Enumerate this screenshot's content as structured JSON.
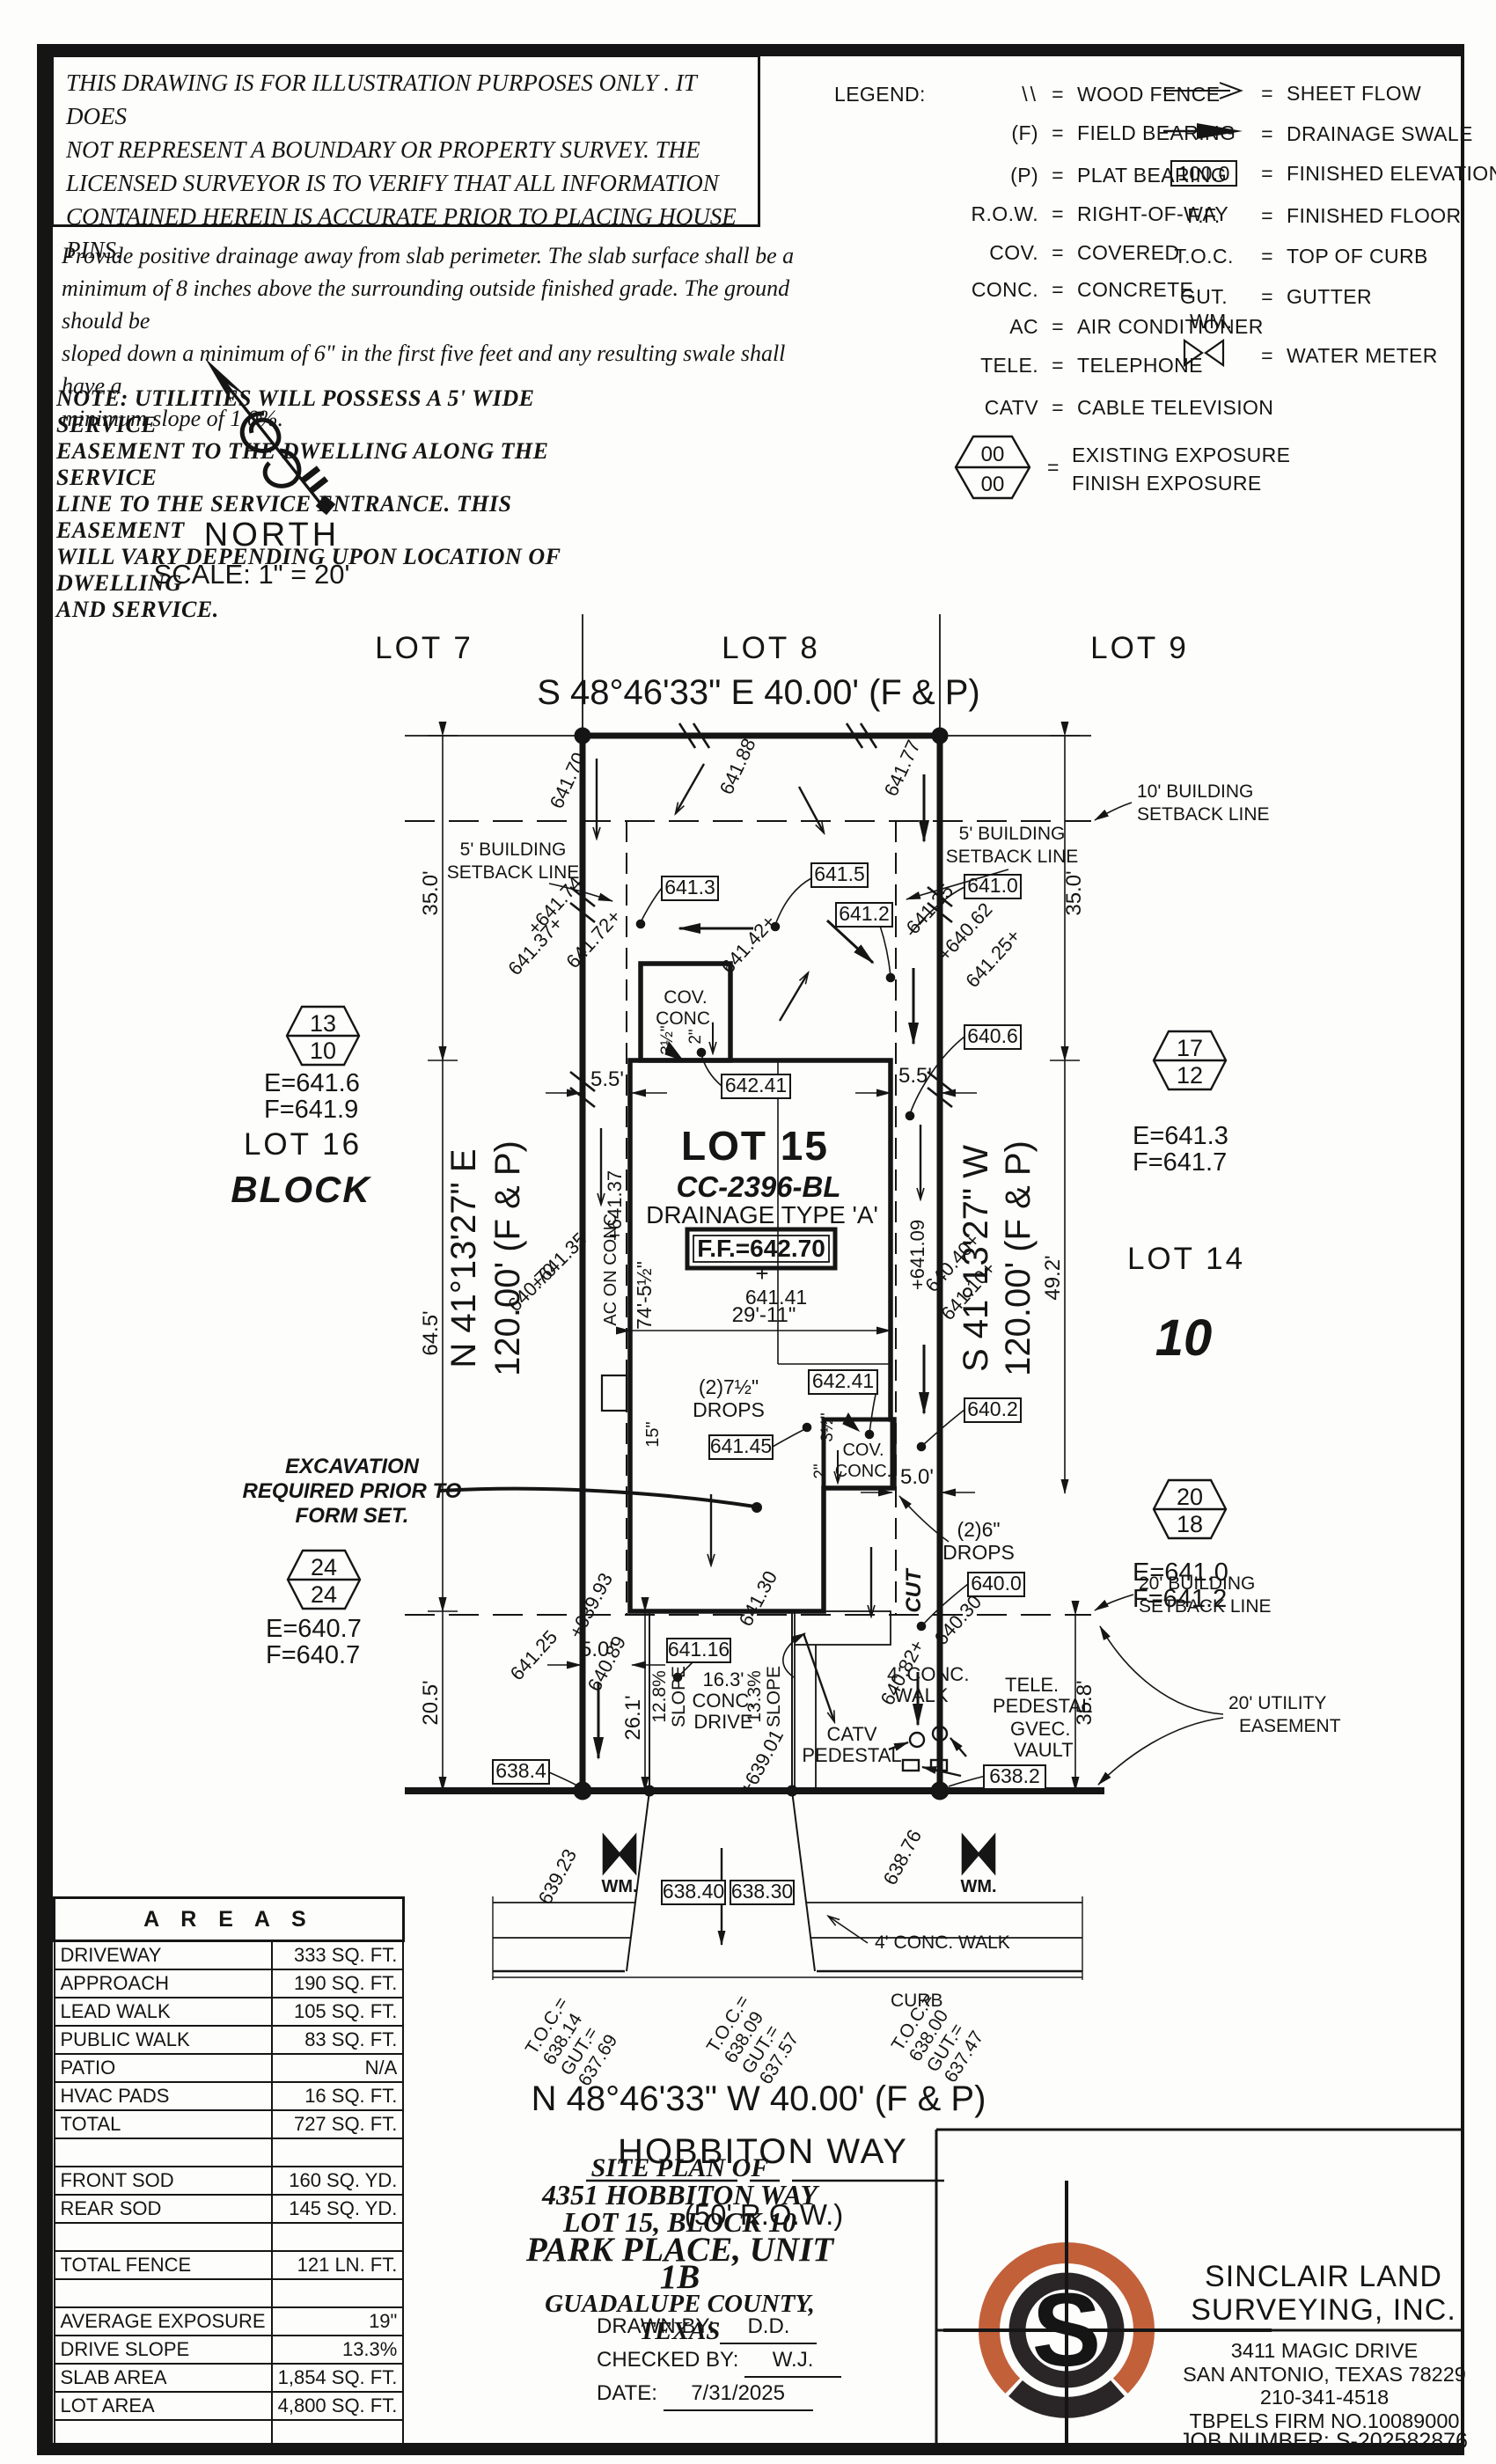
{
  "disclaimer": {
    "l1": "THIS DRAWING IS FOR ILLUSTRATION PURPOSES ONLY . IT DOES",
    "l2": "NOT REPRESENT A BOUNDARY OR PROPERTY SURVEY. THE",
    "l3": "LICENSED SURVEYOR IS TO VERIFY THAT ALL INFORMATION",
    "l4": "CONTAINED HEREIN IS ACCURATE PRIOR TO PLACING HOUSE PINS."
  },
  "drainage_note": {
    "l1": "Provide positive drainage away from slab perimeter. The slab surface shall be a",
    "l2": "minimum of 8 inches above the surrounding outside finished grade. The ground should be",
    "l3": "sloped down a minimum of 6\" in the first five feet and any resulting swale shall have a",
    "l4": "minimum slope of 1.0%."
  },
  "utility_note": {
    "l1": "NOTE:  UTILITIES  WILL  POSSESS  A  5'  WIDE  SERVICE",
    "l2": "EASEMENT  TO  THE  DWELLING  ALONG  THE  SERVICE",
    "l3": "LINE  TO  THE  SERVICE  ENTRANCE.  THIS  EASEMENT",
    "l4": "WILL  VARY  DEPENDING  UPON  LOCATION  OF  DWELLING",
    "l5": "AND  SERVICE."
  },
  "north": {
    "label": "NORTH",
    "scale": "SCALE:  1\" =  20'"
  },
  "legend": {
    "title": "LEGEND:",
    "eq": "=",
    "c1": [
      {
        "sym": "\\\\",
        "desc": "WOOD FENCE"
      },
      {
        "sym": "(F)",
        "desc": "FIELD BEARING"
      },
      {
        "sym": "(P)",
        "desc": "PLAT BEARING"
      },
      {
        "sym": "R.O.W.",
        "desc": "RIGHT-OF-WAY"
      },
      {
        "sym": "COV.",
        "desc": "COVERED"
      },
      {
        "sym": "CONC.",
        "desc": "CONCRETE"
      },
      {
        "sym": "AC",
        "desc": "AIR CONDITIONER"
      },
      {
        "sym": "TELE.",
        "desc": "TELEPHONE"
      },
      {
        "sym": "CATV",
        "desc": "CABLE TELEVISION"
      }
    ],
    "exposure": {
      "top": "00",
      "bottom": "00",
      "d1": "EXISTING EXPOSURE",
      "d2": "FINISH EXPOSURE"
    },
    "c2": [
      {
        "desc": "SHEET FLOW"
      },
      {
        "desc": "DRAINAGE SWALE"
      },
      {
        "sym": "100.0",
        "desc": "FINISHED ELEVATION"
      },
      {
        "sym": "F.F.",
        "desc": "FINISHED FLOOR"
      },
      {
        "sym": "T.O.C.",
        "desc": "TOP OF CURB"
      },
      {
        "sym": "GUT.",
        "desc": "GUTTER"
      },
      {
        "sym": "WM.",
        "desc": "WATER METER"
      }
    ]
  },
  "plan": {
    "bearings": {
      "top": "S 48°46'33\" E 40.00' (F & P)",
      "bottom": "N 48°46'33\" W 40.00' (F & P)",
      "left1": "N 41°13'27\" E",
      "left2": "120.00' (F & P)",
      "right1": "S 41°13'27\" W",
      "right2": "120.00' (F & P)",
      "street": "HOBBITON WAY",
      "row": "(50' R.O.W.)"
    },
    "lots": {
      "l7": "LOT 7",
      "l8": "LOT 8",
      "l9": "LOT 9",
      "l14": "LOT 14",
      "l15": "LOT 15",
      "l16": "LOT 16",
      "block": "BLOCK",
      "b10": "10"
    },
    "parcel": {
      "cc": "CC-2396-BL",
      "drtype": "DRAINAGE TYPE 'A'",
      "ff": "F.F.=642.70"
    },
    "flags": {
      "f1t": "13",
      "f1b": "10",
      "f1e": "E=641.6",
      "f1f": "F=641.9",
      "f2t": "17",
      "f2b": "12",
      "f2e": "E=641.3",
      "f2f": "F=641.7",
      "f3t": "20",
      "f3b": "18",
      "f3e": "E=641.0",
      "f3f": "F=641.2",
      "f4t": "24",
      "f4b": "24",
      "f4e": "E=640.7",
      "f4f": "F=640.7"
    },
    "boxes": {
      "b641_3": "641.3",
      "b641_5": "641.5",
      "b641_2": "641.2",
      "b641_0": "641.0",
      "b640_6": "640.6",
      "b642_41a": "642.41",
      "b642_41b": "642.41",
      "b641_45": "641.45",
      "b641_16": "641.16",
      "b640_2": "640.2",
      "b640_0": "640.0",
      "b638_4": "638.4",
      "b638_2": "638.2",
      "b638_40": "638.40",
      "b638_30": "638.30"
    },
    "spots": {
      "s1": "641.70",
      "s2": "641.88",
      "s3": "641.77",
      "s4": "+641.74",
      "s5": "641.37+",
      "s6": "641.72+",
      "s7": "641.42+",
      "s8": "641.35",
      "s9": "+640.62",
      "s10": "641.25+",
      "s11": "+641.35",
      "s12": "640.70",
      "s13": "+641.37",
      "s14": "+641.09",
      "s15": "640.40+",
      "s16": "641.10+",
      "s17": "+639.93",
      "s18": "641.25",
      "s19": "640.89",
      "s20": "641.30",
      "s21": "640.30",
      "s22": "640.82+",
      "s23": "+639.01",
      "s24": "639.23",
      "s25": "638.76",
      "s26": "641.41",
      "s27": "+"
    },
    "dims": {
      "d35": "35.0'",
      "d645": "64.5'",
      "d205": "20.5'",
      "d492": "49.2'",
      "d358": "35.8'",
      "d55": "5.5'",
      "d50": "5.0'",
      "d261": "26.1'",
      "d2911": "29'-11\"",
      "d74": "74'-5½\"",
      "d15": "15\"",
      "d35i": "3½\"",
      "d2i": "2\""
    },
    "labels": {
      "sb10a": "10' BUILDING",
      "sbline": "SETBACK LINE",
      "sb5a": "5' BUILDING",
      "sb20a": "20' BUILDING",
      "uea": "20' UTILITY",
      "ueb": "EASEMENT",
      "cov": "COV.",
      "conc": "CONC.",
      "drops75": "(2)7½\"",
      "drops6": "(2)6\"",
      "drops": "DROPS",
      "ac": "AC ON CONC.",
      "cut": "CUT",
      "exc1": "EXCAVATION",
      "exc2": "REQUIRED PRIOR TO",
      "exc3": "FORM SET.",
      "slope1": "12.8%",
      "slope2": "13.3%",
      "slopew": "SLOPE",
      "drv1": "16.3'",
      "drv2": "CONC.",
      "drv3": "DRIVE",
      "walk1": "4' CONC.",
      "walk2": "WALK",
      "walkfull": "4' CONC. WALK",
      "curb": "CURB",
      "catv": "CATV",
      "ped": "PEDESTAL",
      "tele": "TELE.",
      "gvec": "GVEC.",
      "vault": "VAULT",
      "wm": "WM."
    },
    "toc": {
      "t": "T.O.C.=",
      "g": "GUT.=",
      "t1": "638.14",
      "g1": "637.69",
      "t2": "638.09",
      "g2": "637.57",
      "t3": "638.00",
      "g3": "637.47"
    }
  },
  "areas": {
    "title": "A R E A S",
    "rows": [
      {
        "label": "DRIVEWAY",
        "value": "333 SQ. FT."
      },
      {
        "label": "APPROACH",
        "value": "190 SQ. FT."
      },
      {
        "label": "LEAD WALK",
        "value": "105 SQ. FT."
      },
      {
        "label": "PUBLIC WALK",
        "value": "83 SQ. FT."
      },
      {
        "label": "PATIO",
        "value": "N/A"
      },
      {
        "label": "HVAC PADS",
        "value": "16 SQ. FT."
      },
      {
        "label": "TOTAL",
        "value": "727 SQ. FT."
      },
      {
        "label": "",
        "value": ""
      },
      {
        "label": "FRONT SOD",
        "value": "160 SQ. YD."
      },
      {
        "label": "REAR SOD",
        "value": "145 SQ. YD."
      },
      {
        "label": "",
        "value": ""
      },
      {
        "label": "TOTAL FENCE",
        "value": "121 LN. FT."
      },
      {
        "label": "",
        "value": ""
      },
      {
        "label": "AVERAGE EXPOSURE",
        "value": "19\""
      },
      {
        "label": "DRIVE SLOPE",
        "value": "13.3%"
      },
      {
        "label": "SLAB AREA",
        "value": "1,854 SQ. FT."
      },
      {
        "label": "LOT AREA",
        "value": "4,800 SQ. FT."
      },
      {
        "label": "",
        "value": ""
      }
    ]
  },
  "titleblock": {
    "l1": "SITE  PLAN  OF",
    "l2": "4351  HOBBITON  WAY",
    "l3": "LOT  15,  BLOCK  10",
    "l4": "PARK  PLACE,  UNIT  1B",
    "l5": "GUADALUPE  COUNTY,  TEXAS",
    "drawn_label": "DRAWN  BY:",
    "drawn": "D.D.",
    "checked_label": "CHECKED  BY:",
    "checked": "W.J.",
    "date_label": "DATE:",
    "date": "7/31/2025"
  },
  "surveyor": {
    "name1": "SINCLAIR  LAND",
    "name2": "SURVEYING,  INC.",
    "addr1": "3411  MAGIC  DRIVE",
    "addr2": "SAN  ANTONIO,  TEXAS  78229",
    "phone": "210-341-4518",
    "firm": "TBPELS  FIRM  NO.10089000",
    "job": "JOB  NUMBER:    S-202582876",
    "monogram": "S",
    "accent": "#c2603a",
    "dark": "#2a2526"
  }
}
